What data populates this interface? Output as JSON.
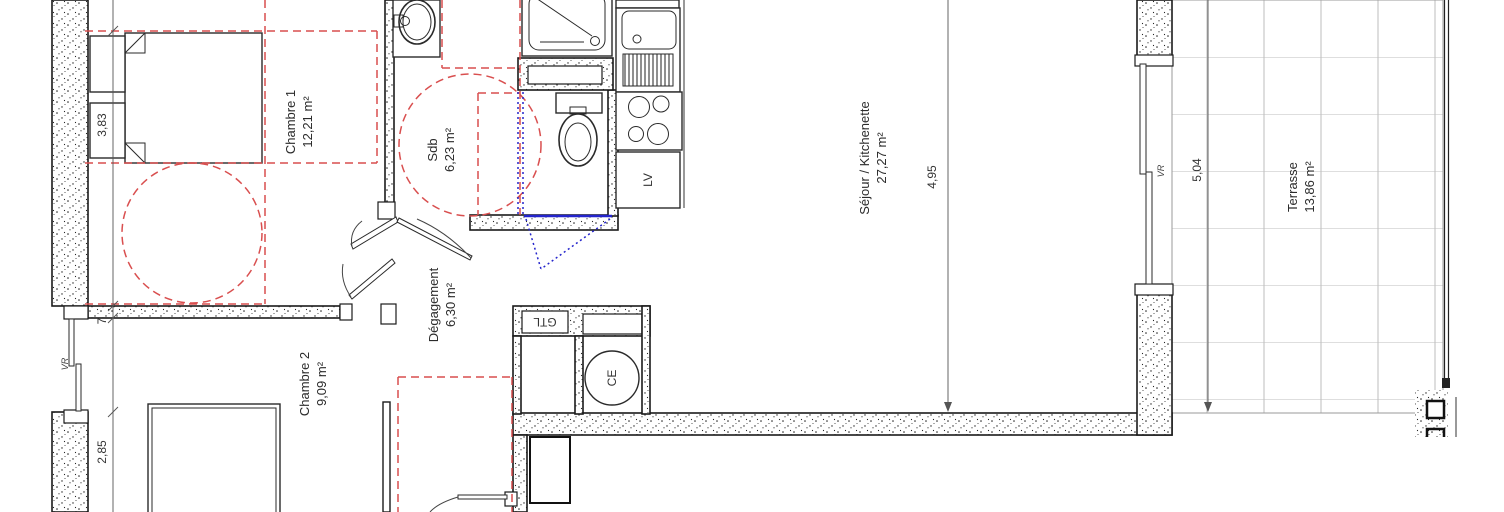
{
  "rooms": {
    "chambre1": {
      "name": "Chambre 1",
      "area": "12,21 m²"
    },
    "sdb": {
      "name": "Sdb",
      "area": "6,23 m²"
    },
    "sejour": {
      "name": "Séjour / Kitchenette",
      "area": "27,27 m²"
    },
    "degagement": {
      "name": "Dégagement",
      "area": "6,30 m²"
    },
    "chambre2": {
      "name": "Chambre 2",
      "area": "9,09 m²"
    },
    "terrasse": {
      "name": "Terrasse",
      "area": "13,86 m²"
    }
  },
  "dimensions": {
    "chambre1_height": "3,83",
    "wall_thickness": "7",
    "chambre2_height": "2,85",
    "sejour_width": "4,95",
    "terrasse_width": "5,04"
  },
  "equipment_labels": {
    "gtl": "GTL",
    "ce": "CE",
    "lv": "LV",
    "vr_left": "VR",
    "vr_terrasse": "VR"
  },
  "colors": {
    "wall": "#1b1b1b",
    "annotation_red": "#d94f4f",
    "annotation_blue": "#2424cc",
    "terrace_grid": "#bdbdbd"
  }
}
